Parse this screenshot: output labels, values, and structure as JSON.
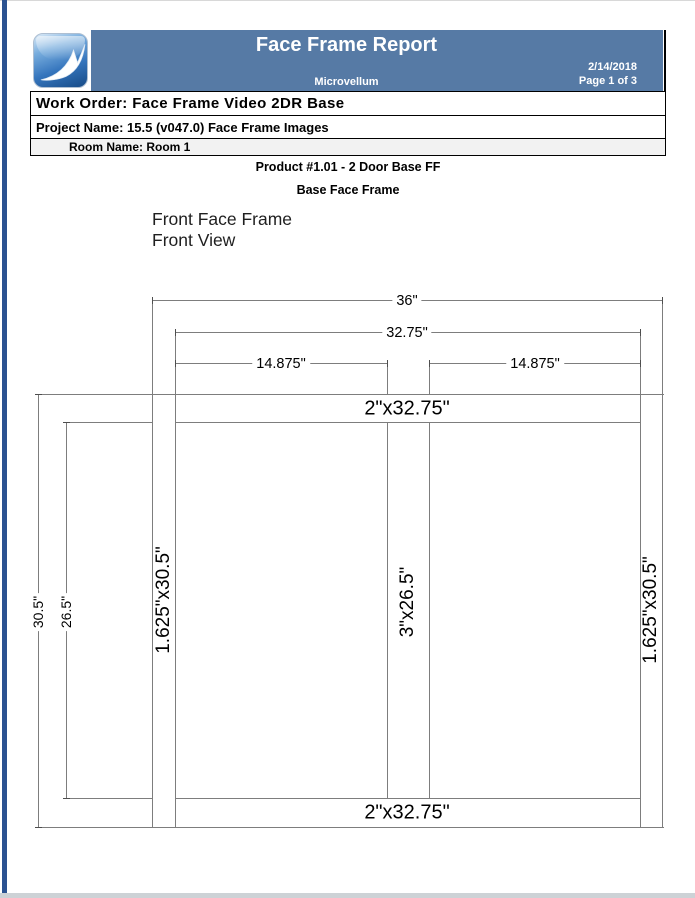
{
  "report": {
    "title": "Face Frame Report",
    "company": "Microvellum",
    "date": "2/14/2018",
    "page_number": "Page 1 of 3",
    "work_order": "Work Order: Face Frame Video 2DR Base",
    "project_name": "Project Name: 15.5 (v047.0) Face Frame Images",
    "room_name": "Room Name: Room 1",
    "product_title": "Product #1.01 - 2 Door Base FF",
    "product_subtitle": "Base Face Frame",
    "view_title_line1": "Front Face Frame",
    "view_title_line2": "Front View"
  },
  "colors": {
    "banner": "#567aa5",
    "accent_bar": "#2b5291",
    "room_row_bg": "#f2f2f2",
    "drawing_line": "#7d7d7d"
  },
  "drawing": {
    "overall_width": "36\"",
    "inner_width": "32.75\"",
    "left_opening_width": "14.875\"",
    "right_opening_width": "14.875\"",
    "top_rail": "2\"x32.75\"",
    "bottom_rail": "2\"x32.75\"",
    "left_stile": "1.625\"x30.5\"",
    "center_stile": "3\"x26.5\"",
    "right_stile": "1.625\"x30.5\"",
    "overall_height": "30.5\"",
    "opening_height": "26.5\""
  }
}
